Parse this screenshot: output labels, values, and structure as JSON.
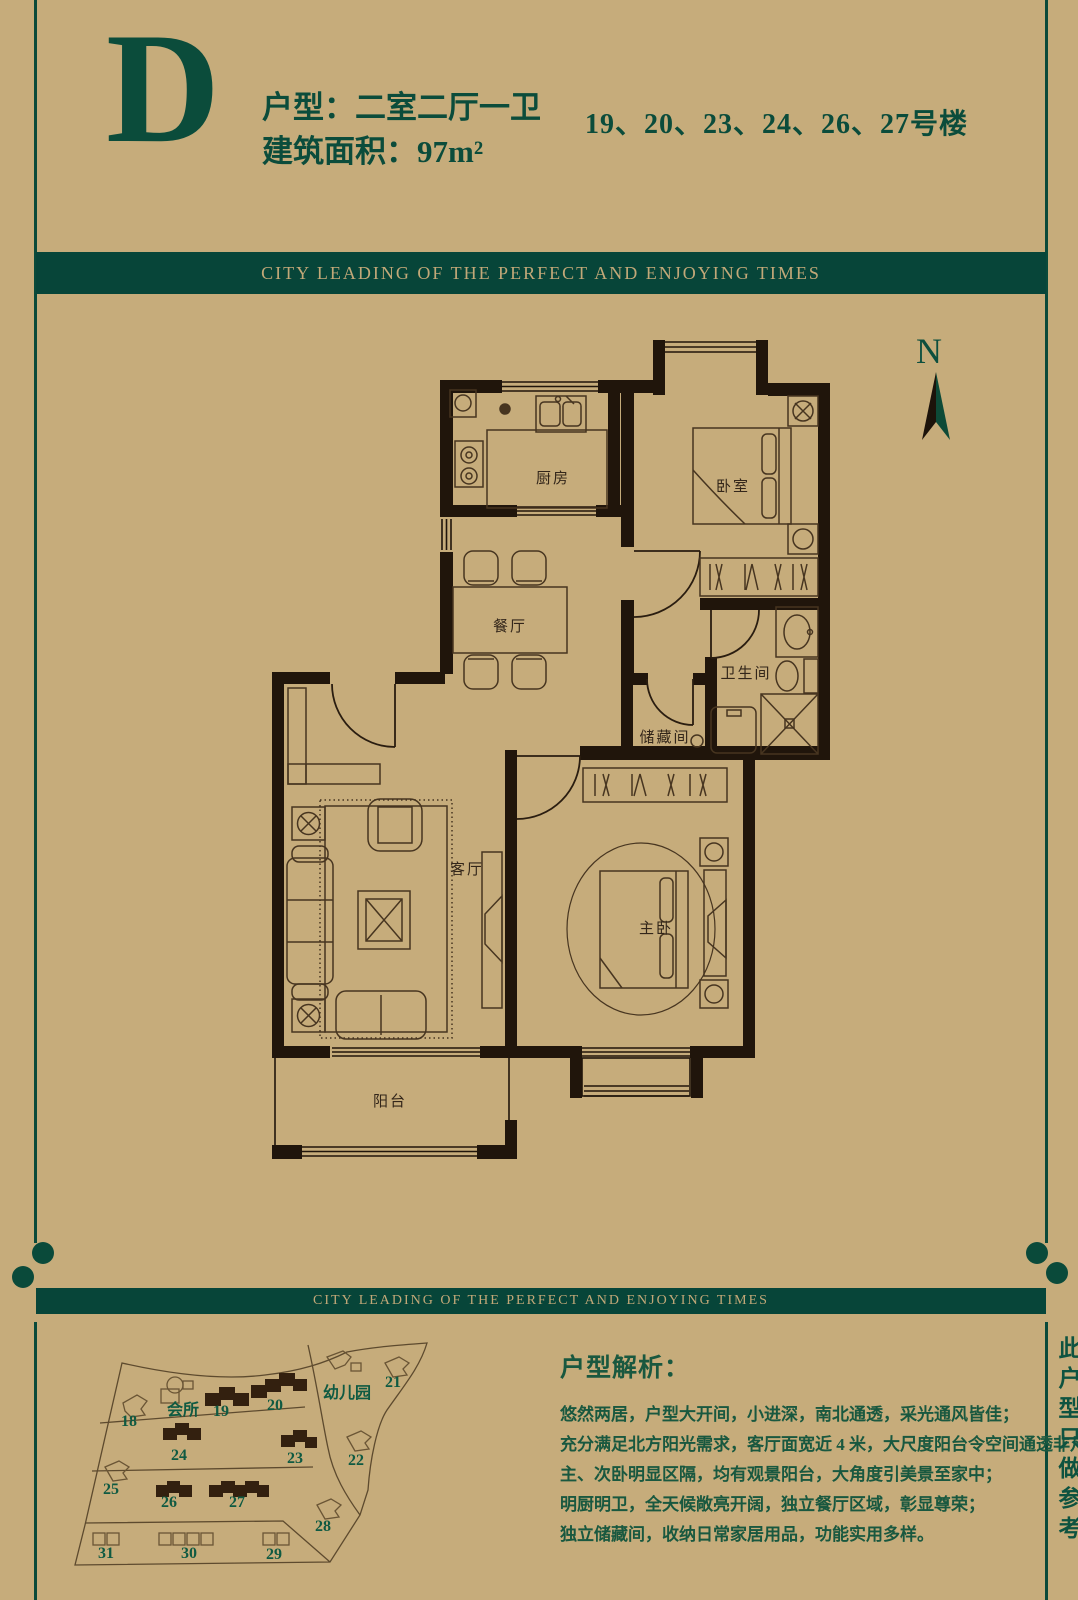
{
  "page": {
    "bg": "#c6ac7b",
    "accent_green": "#0b4c3b",
    "banner_green": "#074539",
    "banner_text_color": "#c2a878",
    "wall_color": "#20150b"
  },
  "header": {
    "letter": "D",
    "type_line": "户型：二室二厅一卫",
    "area_line": "建筑面积：97m²",
    "buildings_line": "19、20、23、24、26、27号楼"
  },
  "banner": {
    "text": "CITY LEADING OF THE PERFECT AND ENJOYING TIMES"
  },
  "compass": {
    "label": "N"
  },
  "floorplan": {
    "rooms": {
      "kitchen": "厨房",
      "bedroom": "卧室",
      "dining": "餐厅",
      "bathroom": "卫生间",
      "storage": "储藏间",
      "living": "客厅",
      "master": "主卧",
      "balcony": "阳台"
    }
  },
  "siteplan": {
    "labels": [
      {
        "text": "会所",
        "x": 112,
        "y": 90
      },
      {
        "text": "19",
        "x": 158,
        "y": 91
      },
      {
        "text": "20",
        "x": 212,
        "y": 85
      },
      {
        "text": "幼儿园",
        "x": 268,
        "y": 73
      },
      {
        "text": "21",
        "x": 330,
        "y": 62
      },
      {
        "text": "18",
        "x": 66,
        "y": 101
      },
      {
        "text": "24",
        "x": 116,
        "y": 135
      },
      {
        "text": "23",
        "x": 232,
        "y": 138
      },
      {
        "text": "22",
        "x": 293,
        "y": 140
      },
      {
        "text": "25",
        "x": 48,
        "y": 169
      },
      {
        "text": "26",
        "x": 106,
        "y": 182
      },
      {
        "text": "27",
        "x": 174,
        "y": 182
      },
      {
        "text": "28",
        "x": 260,
        "y": 206
      },
      {
        "text": "31",
        "x": 43,
        "y": 233
      },
      {
        "text": "30",
        "x": 126,
        "y": 233
      },
      {
        "text": "29",
        "x": 211,
        "y": 234
      }
    ]
  },
  "analysis": {
    "title": "户型解析：",
    "lines": [
      "悠然两居，户型大开间，小进深，南北通透，采光通风皆佳；",
      "充分满足北方阳光需求，客厅面宽近 4 米，大尺度阳台令空间通透非凡；",
      "主、次卧明显区隔，均有观景阳台，大角度引美景至家中；",
      "明厨明卫，全天候敞亮开阔，独立餐厅区域，彰显尊荣；",
      "独立储藏间，收纳日常家居用品，功能实用多样。"
    ]
  },
  "side_note": "此户型只做参考"
}
